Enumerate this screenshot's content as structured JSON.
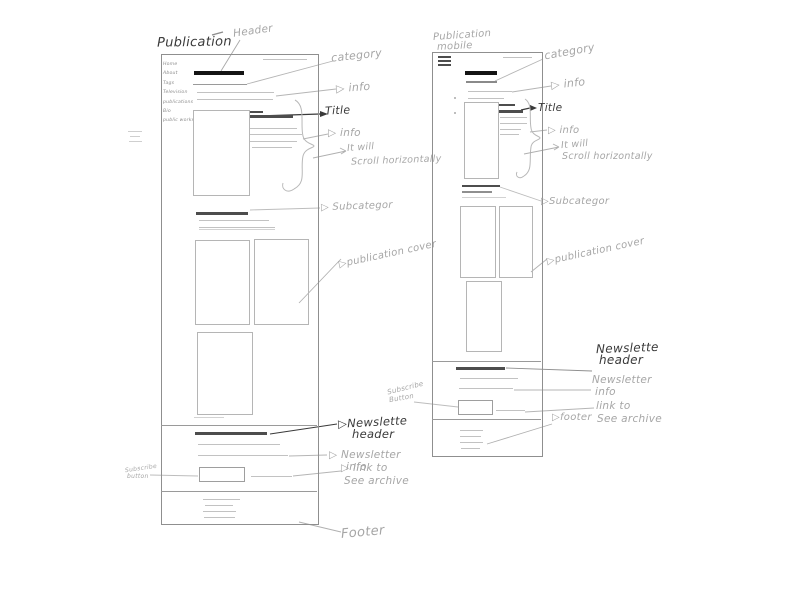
{
  "sketch": {
    "colors": {
      "background": "#ffffff",
      "pencil_dark": "#3a3a3a",
      "pencil_mid": "#9a9a9a",
      "pencil_light": "#c2c2c2",
      "ink_black": "#141414"
    },
    "desktop": {
      "title": "Publication",
      "nav_items": [
        "Home",
        "About",
        "Tags",
        "Television",
        "publications",
        "Bio",
        "public works"
      ],
      "annotations": {
        "header": "Header",
        "category": "category",
        "info_top": "▷ info",
        "title": "Title",
        "info_article": "▷ info",
        "scroll_line1": "It will",
        "scroll_line2": "Scroll horizontally",
        "subcategory": "▷ Subcategor",
        "publication_cover": "▷publication cover",
        "newsletter_header_line1": "▷Newslette",
        "newsletter_header_line2": "header",
        "newsletter_info_line1": "▷ Newsletter",
        "newsletter_info_line2": "info",
        "subscribe_line1": "Subscribe",
        "subscribe_line2": "button",
        "archive_line1": "▷ link to",
        "archive_line2": "See archive",
        "footer": "Footer"
      }
    },
    "mobile": {
      "title_line1": "Publication",
      "title_line2": "mobile",
      "annotations": {
        "category": "category",
        "info_top": "▷ info",
        "title": "Title",
        "info_article": "▷ info",
        "scroll_line1": "It will",
        "scroll_line2": "Scroll horizontally",
        "subcategory": "▷Subcategor",
        "publication_cover": "▷publication cover",
        "newsletter_header_line1": "Newslette",
        "newsletter_header_line2": "header",
        "newsletter_info_line1": "Newsletter",
        "newsletter_info_line2": "info",
        "subscribe_line1": "Subscribe",
        "subscribe_line2": "Button",
        "archive_line1": "link to",
        "archive_line2": "See archive",
        "footer": "▷footer"
      }
    }
  }
}
